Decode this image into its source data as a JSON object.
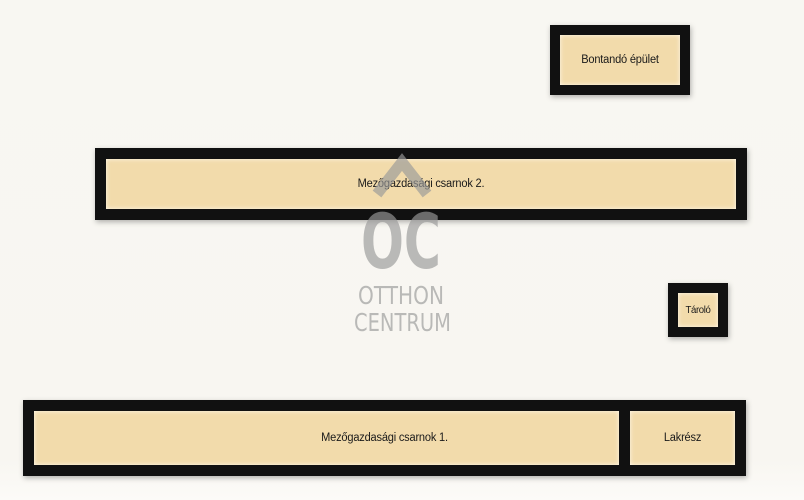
{
  "plan": {
    "type": "site-plan-sketch",
    "buildings": [
      {
        "id": "bontando",
        "label": "Bontandó épület"
      },
      {
        "id": "csarnok2",
        "label": "Mezőgazdasági csarnok 2."
      },
      {
        "id": "tarolo",
        "label": "Tároló"
      },
      {
        "id": "csarnok1",
        "label": "Mezőgazdasági csarnok 1."
      },
      {
        "id": "lakresz",
        "label": "Lakrész"
      }
    ]
  },
  "watermark": {
    "letters": "OC",
    "line1": "OTTHON",
    "line2": "CENTRUM"
  },
  "palette": {
    "background": "#f8f7f2",
    "building_fill": "#f2dbab",
    "building_border": "#111111",
    "label_text": "#1a1a1a",
    "watermark_gray": "#9a9a9a"
  }
}
